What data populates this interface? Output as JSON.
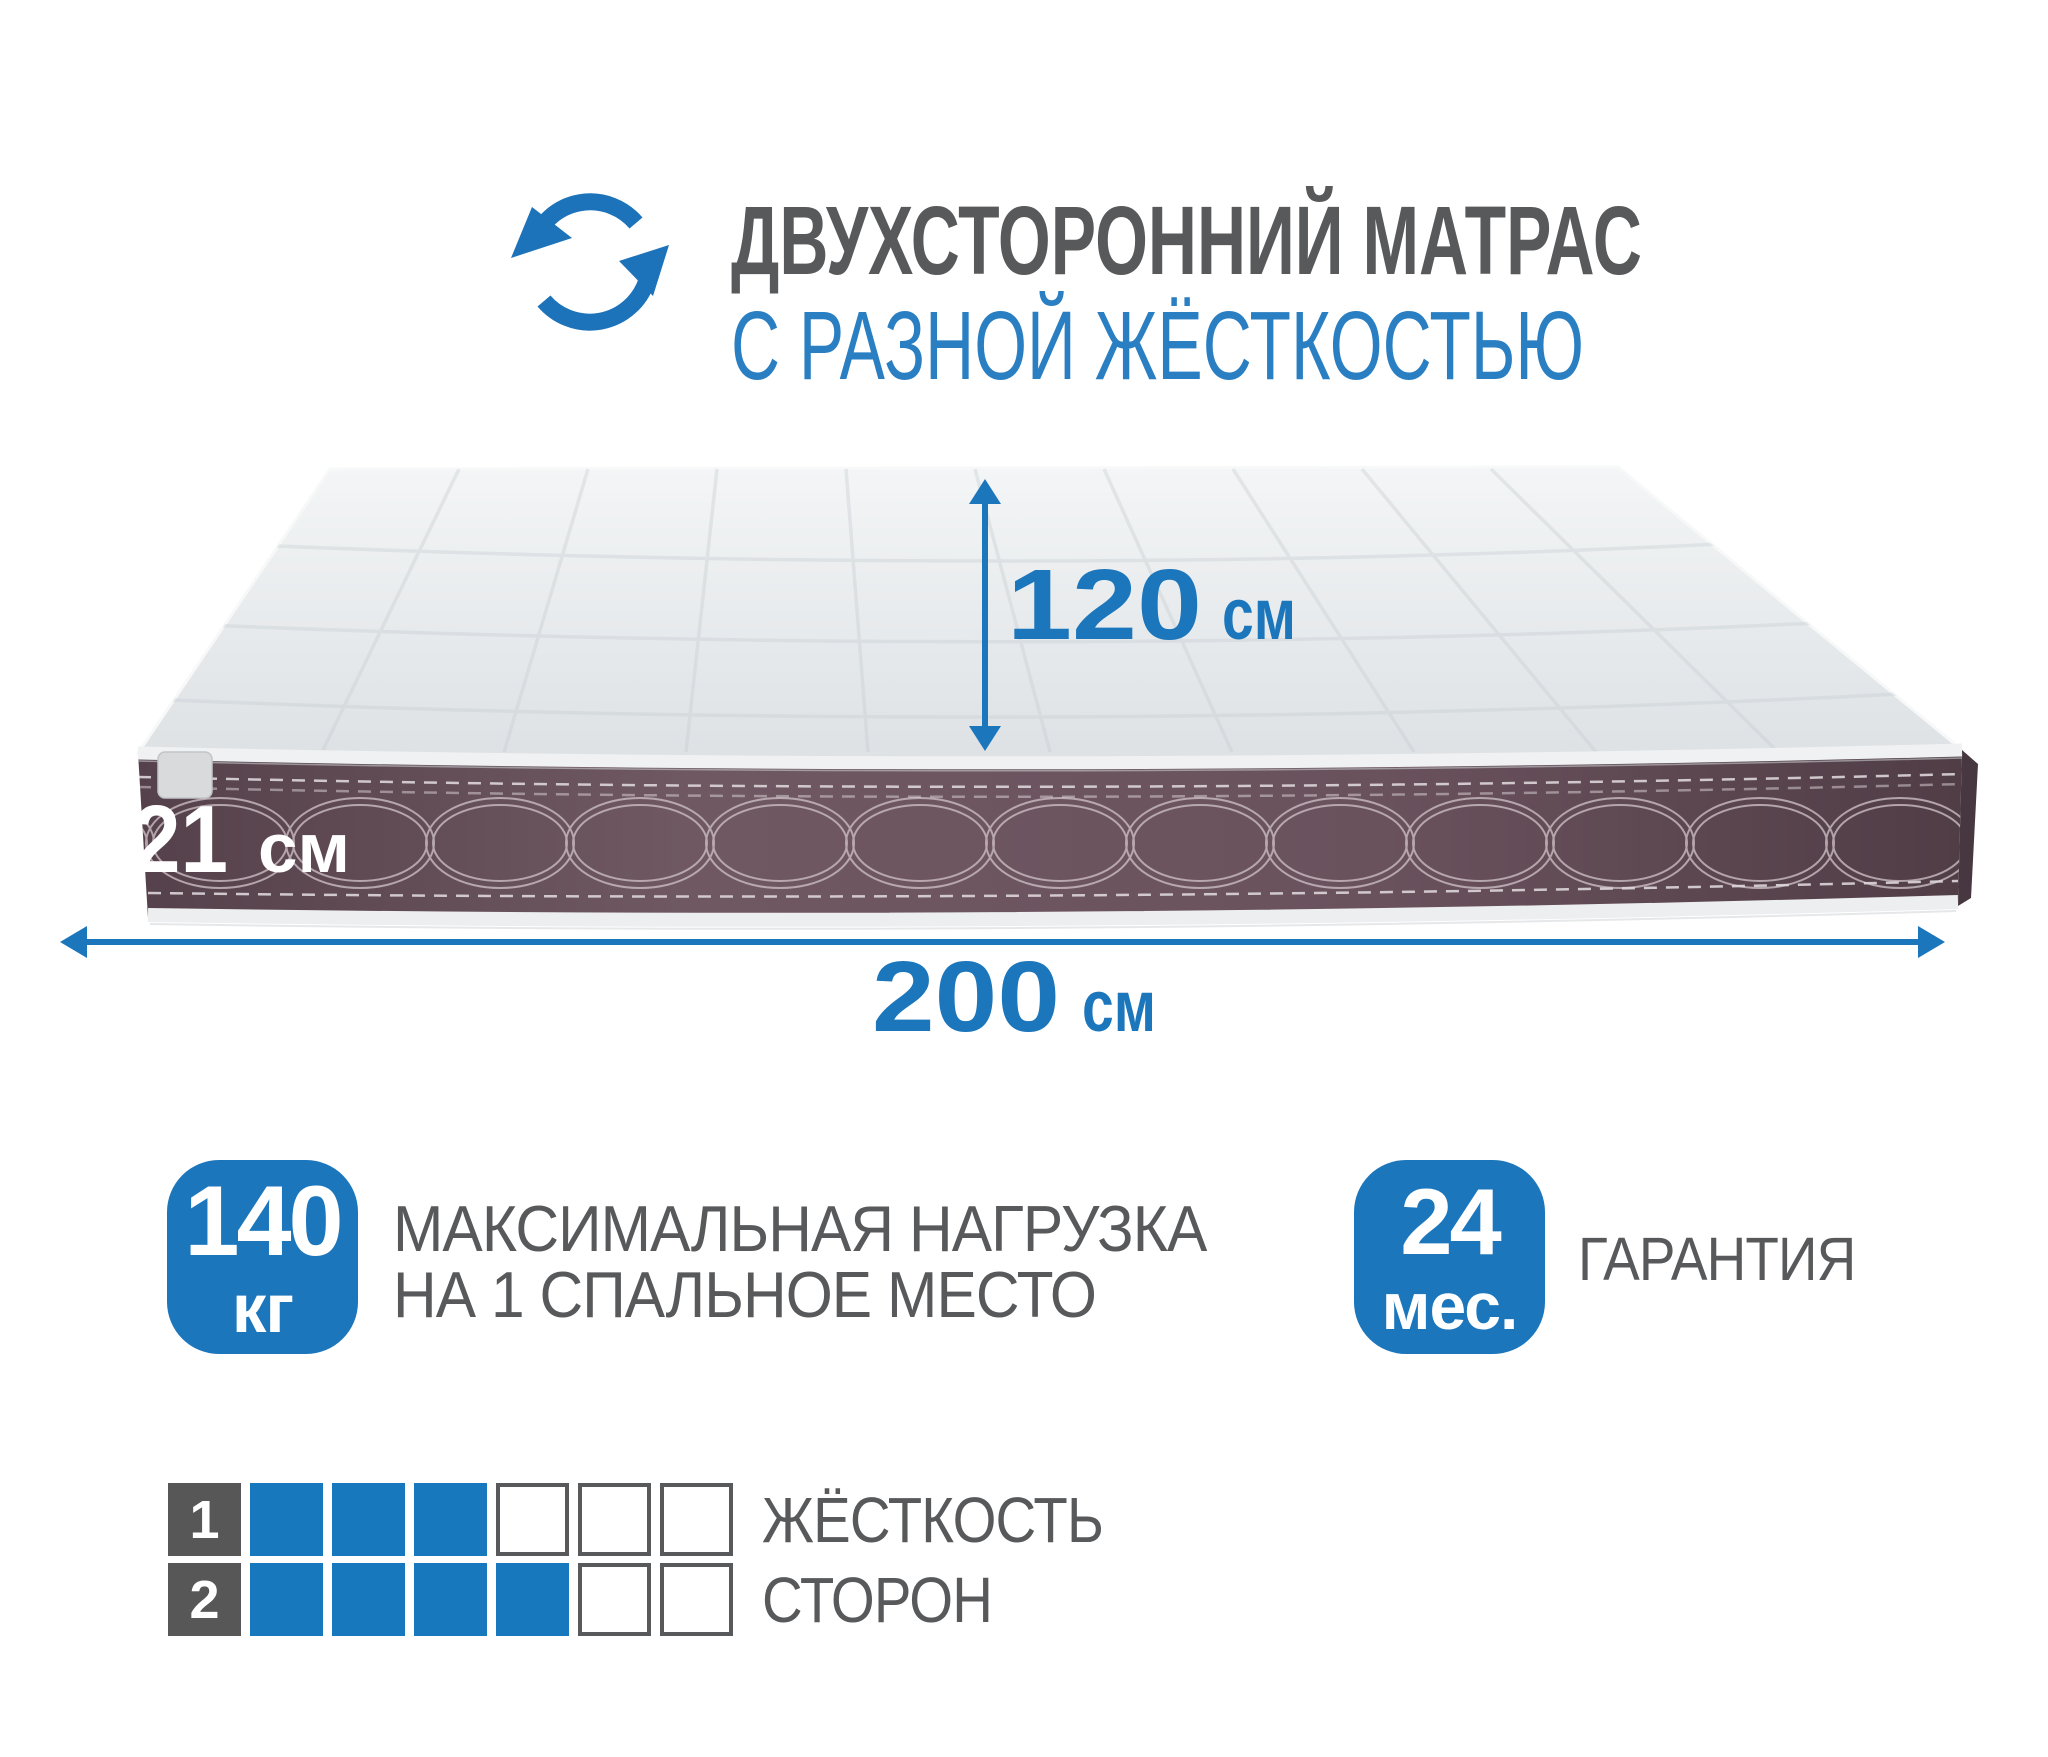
{
  "header": {
    "icon": "rotate-arrows-icon",
    "title": "ДВУХСТОРОННИЙ МАТРАС",
    "subtitle": "С РАЗНОЙ ЖЁСТКОСТЬЮ"
  },
  "dimensions": {
    "depth": {
      "value": "120",
      "unit": "см"
    },
    "thickness": {
      "value": "21",
      "unit": "см"
    },
    "length": {
      "value": "200",
      "unit": "см"
    }
  },
  "badges": [
    {
      "value": "140",
      "unit": "кг",
      "label_line1": "МАКСИМАЛЬНАЯ НАГРУЗКА",
      "label_line2": "НА 1 СПАЛЬНОЕ МЕСТО"
    },
    {
      "value": "24",
      "unit": "мес.",
      "label_line1": "ГАРАНТИЯ"
    }
  ],
  "firmness": {
    "label_line1": "ЖЁСТКОСТЬ",
    "label_line2": "СТОРОН",
    "scale_max": 6,
    "rows": [
      {
        "side": "1",
        "filled": 3
      },
      {
        "side": "2",
        "filled": 4
      }
    ]
  },
  "colors": {
    "accent_blue": "#1b76bc",
    "subtitle_blue": "#2a7fc3",
    "text_gray": "#58595b",
    "band_brown": "#64505a",
    "filled_cell_blue": "#1878be",
    "side_cell_gray": "#575757"
  }
}
